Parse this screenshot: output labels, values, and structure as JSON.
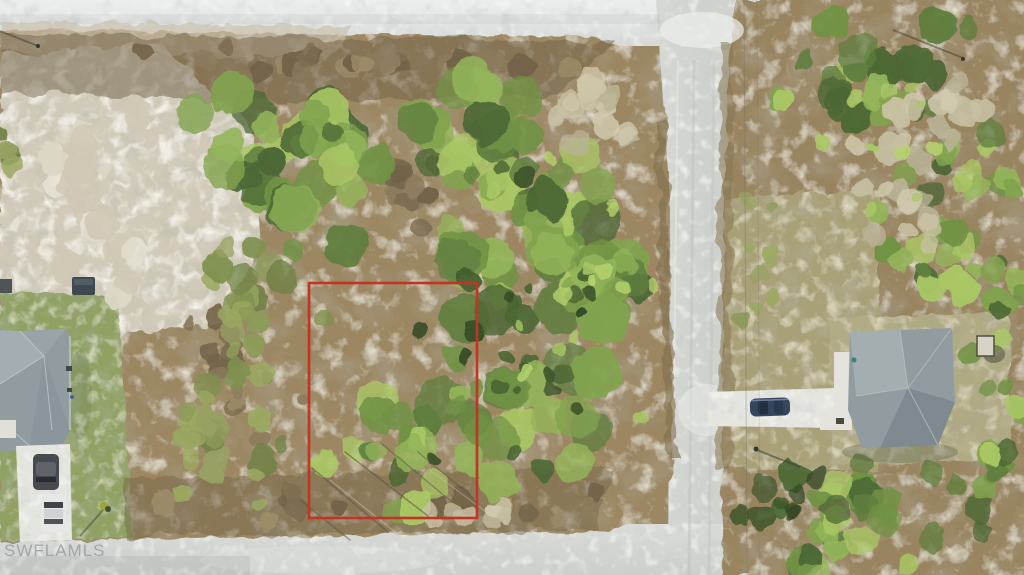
{
  "watermark": {
    "text": "SWFLAMLS"
  },
  "colors": {
    "lot_outline": "#c22e1e",
    "road": "#d6d8d4",
    "canopy": "#7fa24a",
    "scrub": "#9a8560",
    "sand": "#d2cbba",
    "roof": "#8f9b9f"
  }
}
